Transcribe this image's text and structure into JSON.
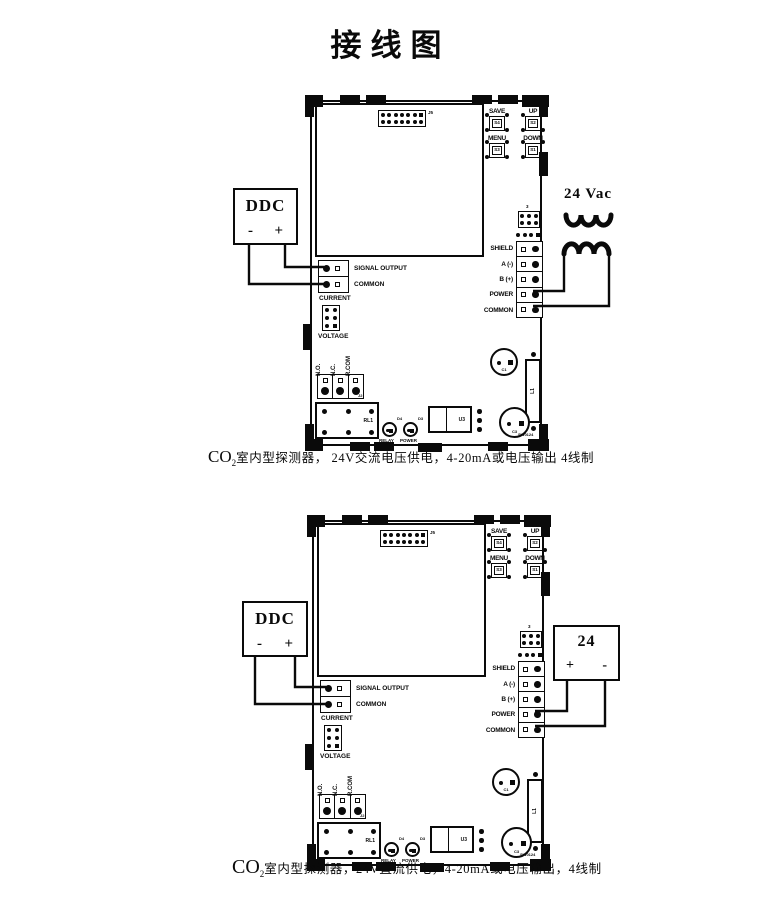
{
  "title": "接线图",
  "ddc": {
    "label": "DDC",
    "minus": "-",
    "plus": "+"
  },
  "board": {
    "connector_label": "J5",
    "buttons": [
      {
        "label": "SAVE",
        "code": "S4"
      },
      {
        "label": "UP",
        "code": "S2"
      },
      {
        "label": "MENU",
        "code": "S3"
      },
      {
        "label": "DOWN",
        "code": "S1"
      }
    ],
    "jumper3_label": "3",
    "comm_block_label": "J10",
    "comm_terminals": [
      "SHIELD",
      "A (-)",
      "B (+)",
      "POWER",
      "COMMON"
    ],
    "output_terminals": [
      "SIGNAL OUTPUT",
      "COMMON"
    ],
    "mode_labels": [
      "CURRENT",
      "VOLTAGE"
    ],
    "relay_contact_labels": [
      "N.O.",
      "N.C.",
      "R.COM"
    ],
    "relay_block_label": "J2",
    "relay_label": "RL1",
    "leds": [
      {
        "code": "D4",
        "label": "RELAY"
      },
      {
        "code": "D3",
        "label": "POWER"
      }
    ],
    "ic_label": "U3",
    "q1_label": "C1",
    "l1_label": "L1",
    "q3_label": "C3",
    "corner_code": "SW0124"
  },
  "diagram1": {
    "supply_label": "24 Vac",
    "caption": {
      "co": "CO",
      "sub": "2",
      "rest": "室内型探测器，  24V交流电压供电，4-20mA或电压输出  4线制"
    }
  },
  "diagram2": {
    "supply": {
      "label": "24",
      "plus": "+",
      "minus": "-"
    },
    "caption": {
      "co": "CO",
      "sub": "2",
      "rest": "室内型探测器，24V直流供电，4-20mA或电压输出，4线制"
    }
  }
}
